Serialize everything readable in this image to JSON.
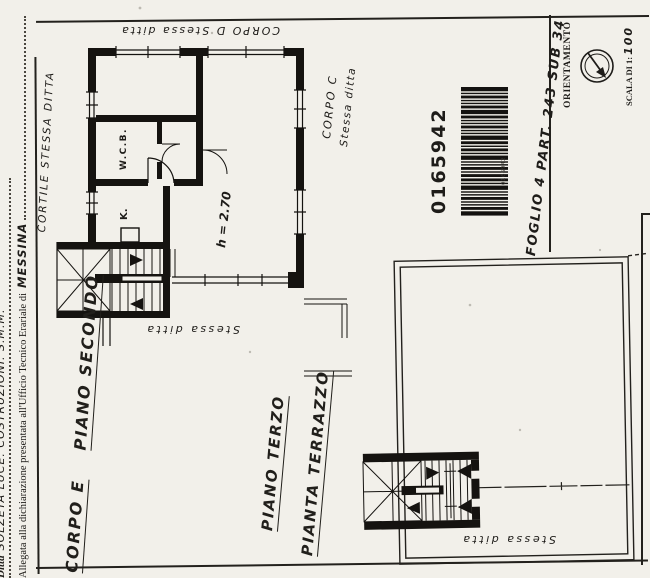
{
  "margin_notes": {
    "ditta_label": "Ditta",
    "ditta_value": "SOLZETA LUCE. COSTRUZIONI. S.M.M.",
    "declaration_text": "Allegata alla dichiarazione presentata all'Ufficio Tecnico Erariale di",
    "declaration_city": "MESSINA"
  },
  "stamp": {
    "barcode_number": "0165942",
    "barcode_number_small": "0165942",
    "reference": "FOGLIO 4  PART. 243 SUB 34"
  },
  "orientation_box": {
    "title": "ORIENTAMENTO",
    "scale_prefix": "SCALA DI 1:",
    "scale_value": "100"
  },
  "upper_plan": {
    "courtyard_label": "CORTILE  STESSA DITTA",
    "corpo_d_label": "CORPO D   Stessa ditta",
    "corpo_c_line1": "CORPO C",
    "corpo_c_line2": "Stessa ditta",
    "wc_label": "W.C.B.",
    "kitchen_label": "K.",
    "height_label": "h = 2.70",
    "stessa_ditta_label": "Stessa  ditta"
  },
  "terrace_plan": {
    "stessa_ditta_label": "Stessa  ditta"
  },
  "captions": {
    "corpo_e": "CORPO E",
    "piano_secondo": "PIANO SECONDO",
    "piano_terzo": "PIANO TERZO",
    "pianta_terrazzo": "PIANTA TERRAZZO"
  },
  "colors": {
    "ink": "#1e1c19",
    "paper": "#f2f0ea"
  }
}
